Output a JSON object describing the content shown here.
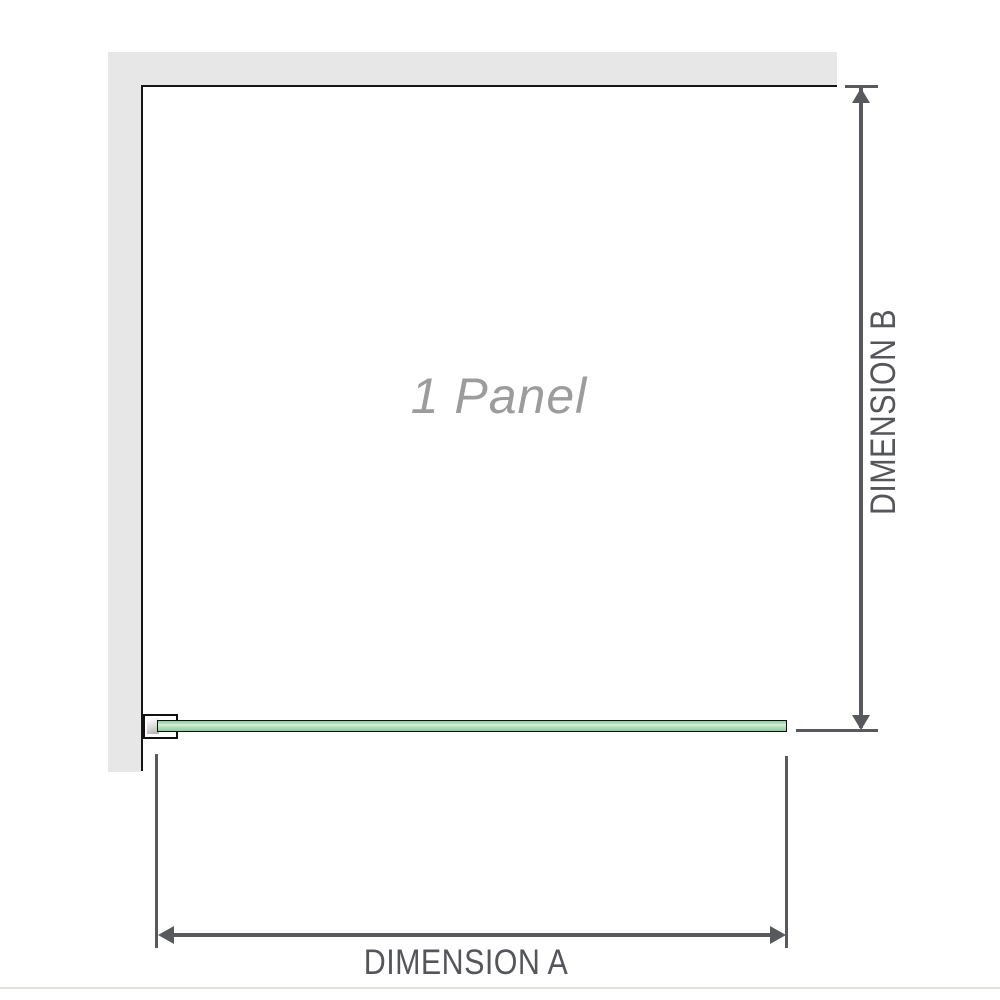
{
  "diagram": {
    "type": "shower-screen-dimension-diagram",
    "panel_label": "1 Panel",
    "dimension_a_label": "DIMENSION A",
    "dimension_b_label": "DIMENSION B"
  },
  "colors": {
    "wall_fill": "#e7e7e7",
    "wall_outline": "#161616",
    "dimension_line": "#58595c",
    "dimension_text": "#54565a",
    "panel_label_text": "#9c9c9c",
    "glass_green": "#a0d6ae",
    "glass_highlight": "#ddefe0",
    "bracket_metal": "#b2b2b2",
    "bottom_divider": "#e3e1dc"
  }
}
